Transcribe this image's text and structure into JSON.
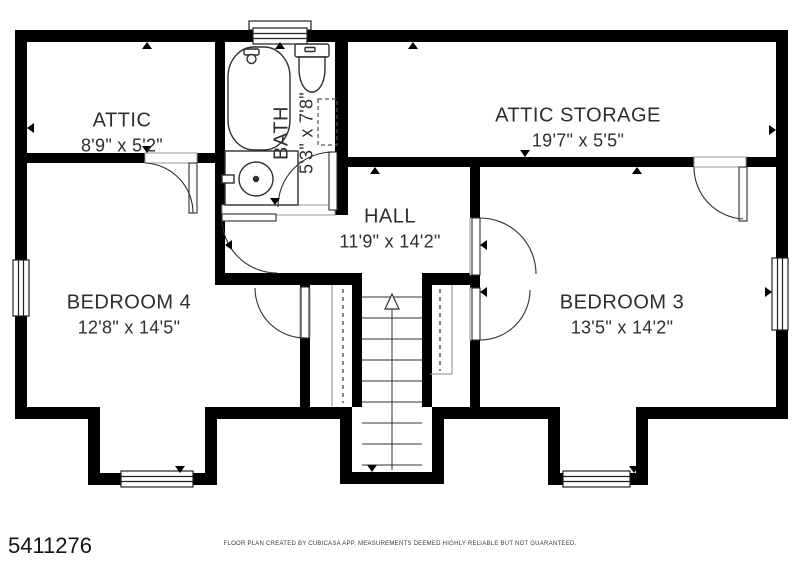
{
  "rooms": [
    {
      "id": "attic",
      "name": "ATTIC",
      "dimensions": "8'9\" x 5'2\""
    },
    {
      "id": "bath",
      "name": "BATH",
      "dimensions": "5'3\" x 7'8\""
    },
    {
      "id": "attic_storage",
      "name": "ATTIC STORAGE",
      "dimensions": "19'7\" x 5'5\""
    },
    {
      "id": "hall",
      "name": "HALL",
      "dimensions": "11'9\" x 14'2\""
    },
    {
      "id": "bedroom4",
      "name": "BEDROOM 4",
      "dimensions": "12'8\" x 14'5\""
    },
    {
      "id": "bedroom3",
      "name": "BEDROOM 3",
      "dimensions": "13'5\" x 14'2\""
    }
  ],
  "footer": {
    "listing_number": "5411276",
    "disclaimer": "FLOOR PLAN CREATED BY CUBICASA APP. MEASUREMENTS DEEMED HIGHLY RELIABLE BUT NOT GUARANTEED."
  },
  "symbols": [
    "bathtub",
    "toilet",
    "sink",
    "staircase-up",
    "wardrobe-rail",
    "door-swing",
    "window"
  ],
  "colors": {
    "wall": "#000000",
    "background": "#ffffff",
    "label_text": "#2e2e2e",
    "fixture_line": "#2f2f2f",
    "shelf_line": "#8a8a8a"
  }
}
